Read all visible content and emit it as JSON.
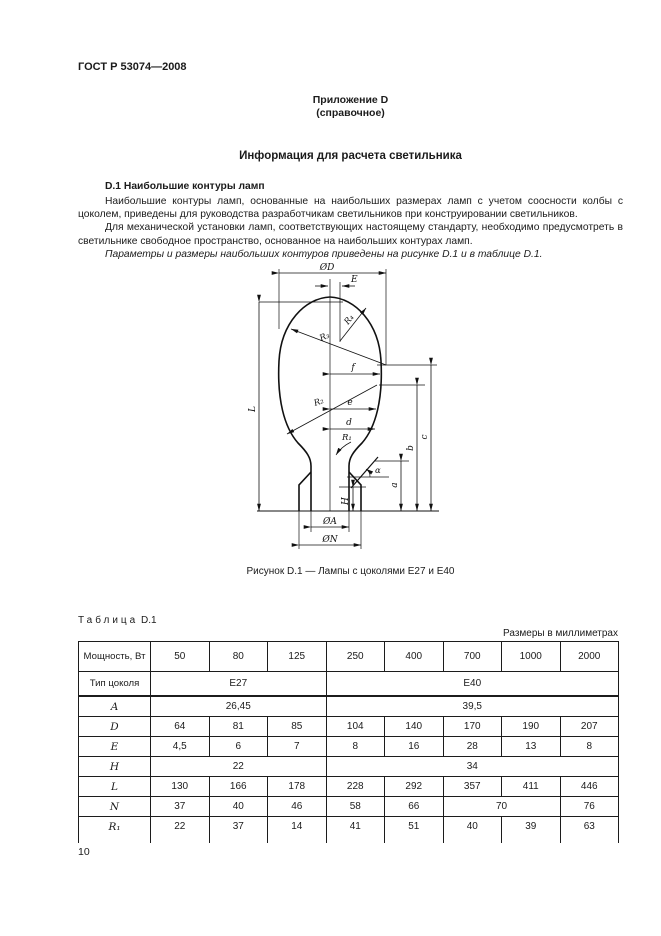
{
  "page": {
    "doc_code": "ГОСТ Р 53074—2008",
    "annex_line1": "Приложение D",
    "annex_line2": "(справочное)",
    "title": "Информация для расчета светильника",
    "section_heading": "D.1 Наибольшие контуры ламп",
    "paragraphs": [
      "Наибольшие контуры ламп, основанные на наибольших размерах ламп с учетом соосности колбы с цоколем, приведены для руководства разработчикам светильников при конструировании светильников.",
      "Для механической установки ламп, соответствующих настоящему стандарту, необходимо предусмотреть в светильнике свободное пространство, основанное на наибольших контурах ламп.",
      "Параметры и размеры наибольших контуров приведены на рисунке D.1 и в таблице D.1."
    ],
    "page_number": "10"
  },
  "figure": {
    "caption": "Рисунок D.1 — Лампы с цоколями Е27 и Е40",
    "labels": {
      "diameter_d": "ØD",
      "cap_offset_e": "E",
      "r1": "R₁",
      "r2": "R₂",
      "r3": "R₃",
      "r4": "R₄",
      "f": "f",
      "e": "e",
      "d": "d",
      "alpha": "α",
      "a": "a",
      "b": "b",
      "c": "c",
      "h": "H",
      "l": "L",
      "base_a": "ØA",
      "base_n": "ØN"
    }
  },
  "table": {
    "label_word": "Таблица",
    "label_number": "D.1",
    "units_note": "Размеры в миллиметрах",
    "rows": [
      {
        "label": "Мощность, Вт",
        "header": true,
        "cells": [
          {
            "v": "50"
          },
          {
            "v": "80"
          },
          {
            "v": "125"
          },
          {
            "v": "250"
          },
          {
            "v": "400"
          },
          {
            "v": "700"
          },
          {
            "v": "1000"
          },
          {
            "v": "2000"
          }
        ]
      },
      {
        "label": "Тип цоколя",
        "base_row": true,
        "thick_bottom": true,
        "cells": [
          {
            "v": "Е27",
            "span": 3
          },
          {
            "v": "Е40",
            "span": 5
          }
        ]
      },
      {
        "label": "A",
        "italic": true,
        "cells": [
          {
            "v": "26,45",
            "span": 3
          },
          {
            "v": "39,5",
            "span": 5
          }
        ]
      },
      {
        "label": "D",
        "italic": true,
        "cells": [
          {
            "v": "64"
          },
          {
            "v": "81"
          },
          {
            "v": "85"
          },
          {
            "v": "104"
          },
          {
            "v": "140"
          },
          {
            "v": "170"
          },
          {
            "v": "190"
          },
          {
            "v": "207"
          }
        ]
      },
      {
        "label": "E",
        "italic": true,
        "cells": [
          {
            "v": "4,5"
          },
          {
            "v": "6"
          },
          {
            "v": "7"
          },
          {
            "v": "8"
          },
          {
            "v": "16"
          },
          {
            "v": "28"
          },
          {
            "v": "13"
          },
          {
            "v": "8"
          }
        ]
      },
      {
        "label": "H",
        "italic": true,
        "cells": [
          {
            "v": "22",
            "span": 3
          },
          {
            "v": "34",
            "span": 5
          }
        ]
      },
      {
        "label": "L",
        "italic": true,
        "cells": [
          {
            "v": "130"
          },
          {
            "v": "166"
          },
          {
            "v": "178"
          },
          {
            "v": "228"
          },
          {
            "v": "292"
          },
          {
            "v": "357"
          },
          {
            "v": "411"
          },
          {
            "v": "446"
          }
        ]
      },
      {
        "label": "N",
        "italic": true,
        "cells": [
          {
            "v": "37"
          },
          {
            "v": "40"
          },
          {
            "v": "46"
          },
          {
            "v": "58"
          },
          {
            "v": "66"
          },
          {
            "v": "70",
            "span": 2
          },
          {
            "v": "76"
          }
        ]
      },
      {
        "label": "R₁",
        "italic": true,
        "open_bottom": true,
        "cells": [
          {
            "v": "22"
          },
          {
            "v": "37"
          },
          {
            "v": "14"
          },
          {
            "v": "41"
          },
          {
            "v": "51"
          },
          {
            "v": "40"
          },
          {
            "v": "39"
          },
          {
            "v": "63"
          }
        ]
      }
    ]
  }
}
